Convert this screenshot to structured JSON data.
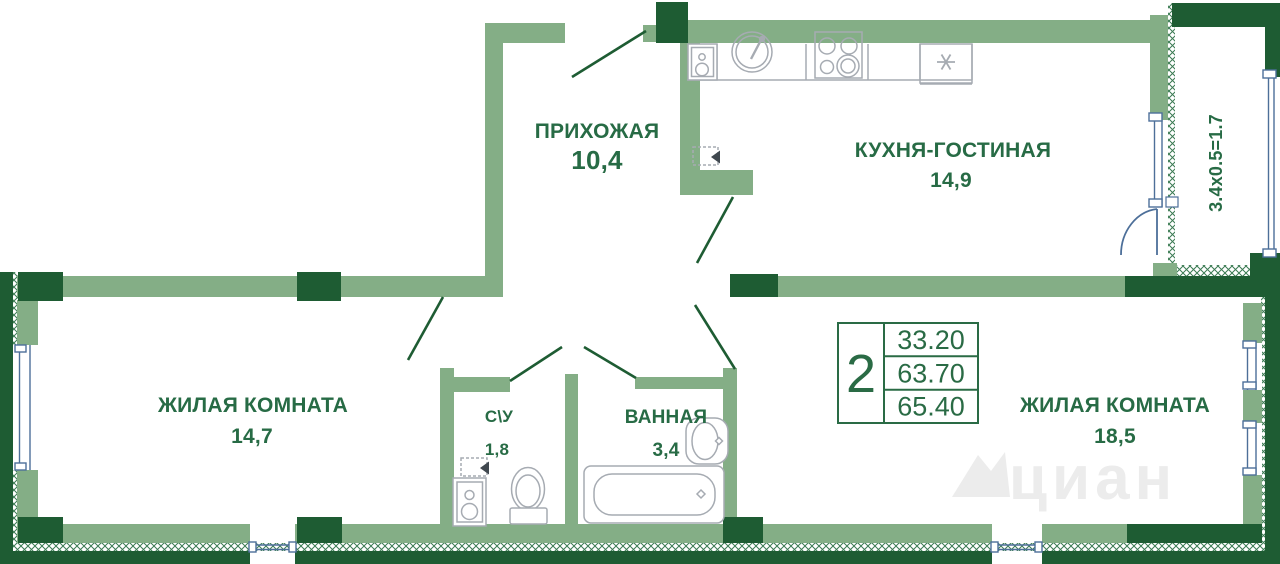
{
  "plan": {
    "watermark": "циан",
    "balcony": {
      "dim": "3.4x0.5=1.7"
    },
    "rooms": {
      "hallway": {
        "label": "ПРИХОЖАЯ",
        "area": "10,4"
      },
      "kitchen": {
        "label": "КУХНЯ-ГОСТИНАЯ",
        "area": "14,9"
      },
      "living1": {
        "label": "ЖИЛАЯ КОМНАТА",
        "area": "14,7"
      },
      "wc": {
        "label": "С\\У",
        "area": "1,8"
      },
      "bath": {
        "label": "ВАННАЯ",
        "area": "3,4"
      },
      "living2": {
        "label": "ЖИЛАЯ КОМНАТА",
        "area": "18,5"
      }
    },
    "summary": {
      "rooms_count": "2",
      "row1": "33.20",
      "row2": "63.70",
      "row3": "65.40"
    },
    "colors": {
      "wall_dark": "#1e5c33",
      "wall_light": "#84ae86",
      "text_green": "#276b45",
      "window_blue": "#4d6f99",
      "fixture_gray": "#a6abb2",
      "watermark_gray": "#ececec"
    }
  }
}
